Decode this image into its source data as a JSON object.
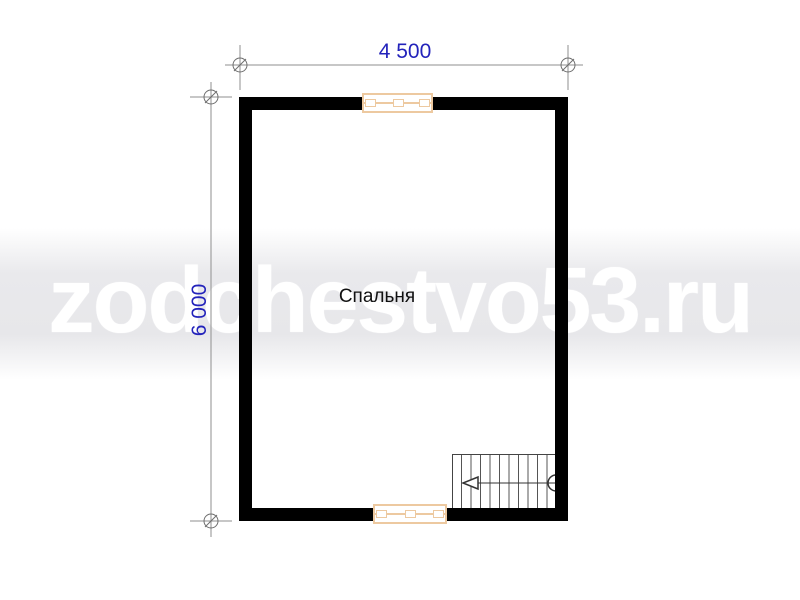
{
  "page": {
    "background": "#ffffff"
  },
  "watermark": {
    "text": "zodchestvo53.ru",
    "text_color": "#ffffff",
    "band_color": "#e9e9ec"
  },
  "plan": {
    "room": {
      "label": "Спальня",
      "text_color": "#111111"
    },
    "dimensions": {
      "width_label": "4 500",
      "height_label": "6 000",
      "text_color": "#2323bb",
      "line_color": "#8f8f8f"
    },
    "walls": {
      "color": "#000000"
    },
    "windows": {
      "frame_color": "#edc9a0",
      "positions": [
        "top-center",
        "bottom-center"
      ]
    },
    "stairs": {
      "location": "bottom-right",
      "treads": 11,
      "arrow_direction": "left"
    }
  }
}
